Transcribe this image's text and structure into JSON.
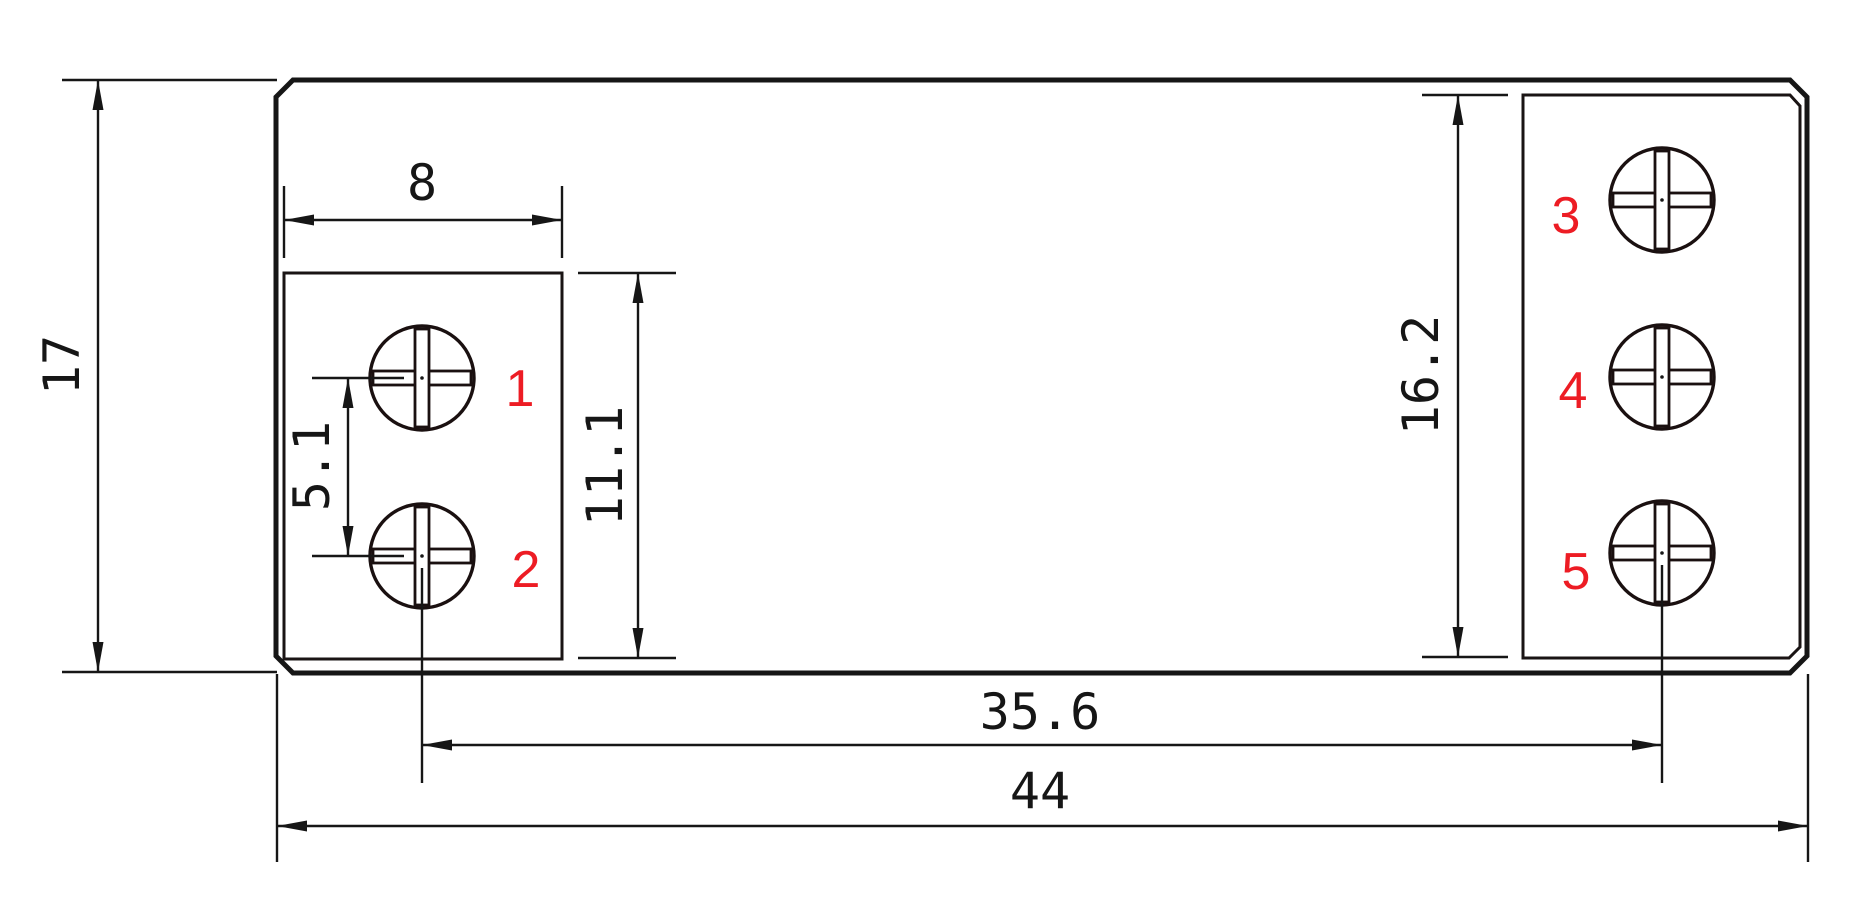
{
  "colors": {
    "background": "#ffffff",
    "line": "#161616",
    "label_red": "#ed1c24"
  },
  "dimensions": {
    "overall_height": "17",
    "left_block_width": "8",
    "screw_pitch_left": "5.1",
    "left_block_height": "11.1",
    "right_block_height": "16.2",
    "screw_span": "35.6",
    "overall_width": "44"
  },
  "terminals": [
    {
      "id": "1"
    },
    {
      "id": "2"
    },
    {
      "id": "3"
    },
    {
      "id": "4"
    },
    {
      "id": "5"
    }
  ]
}
